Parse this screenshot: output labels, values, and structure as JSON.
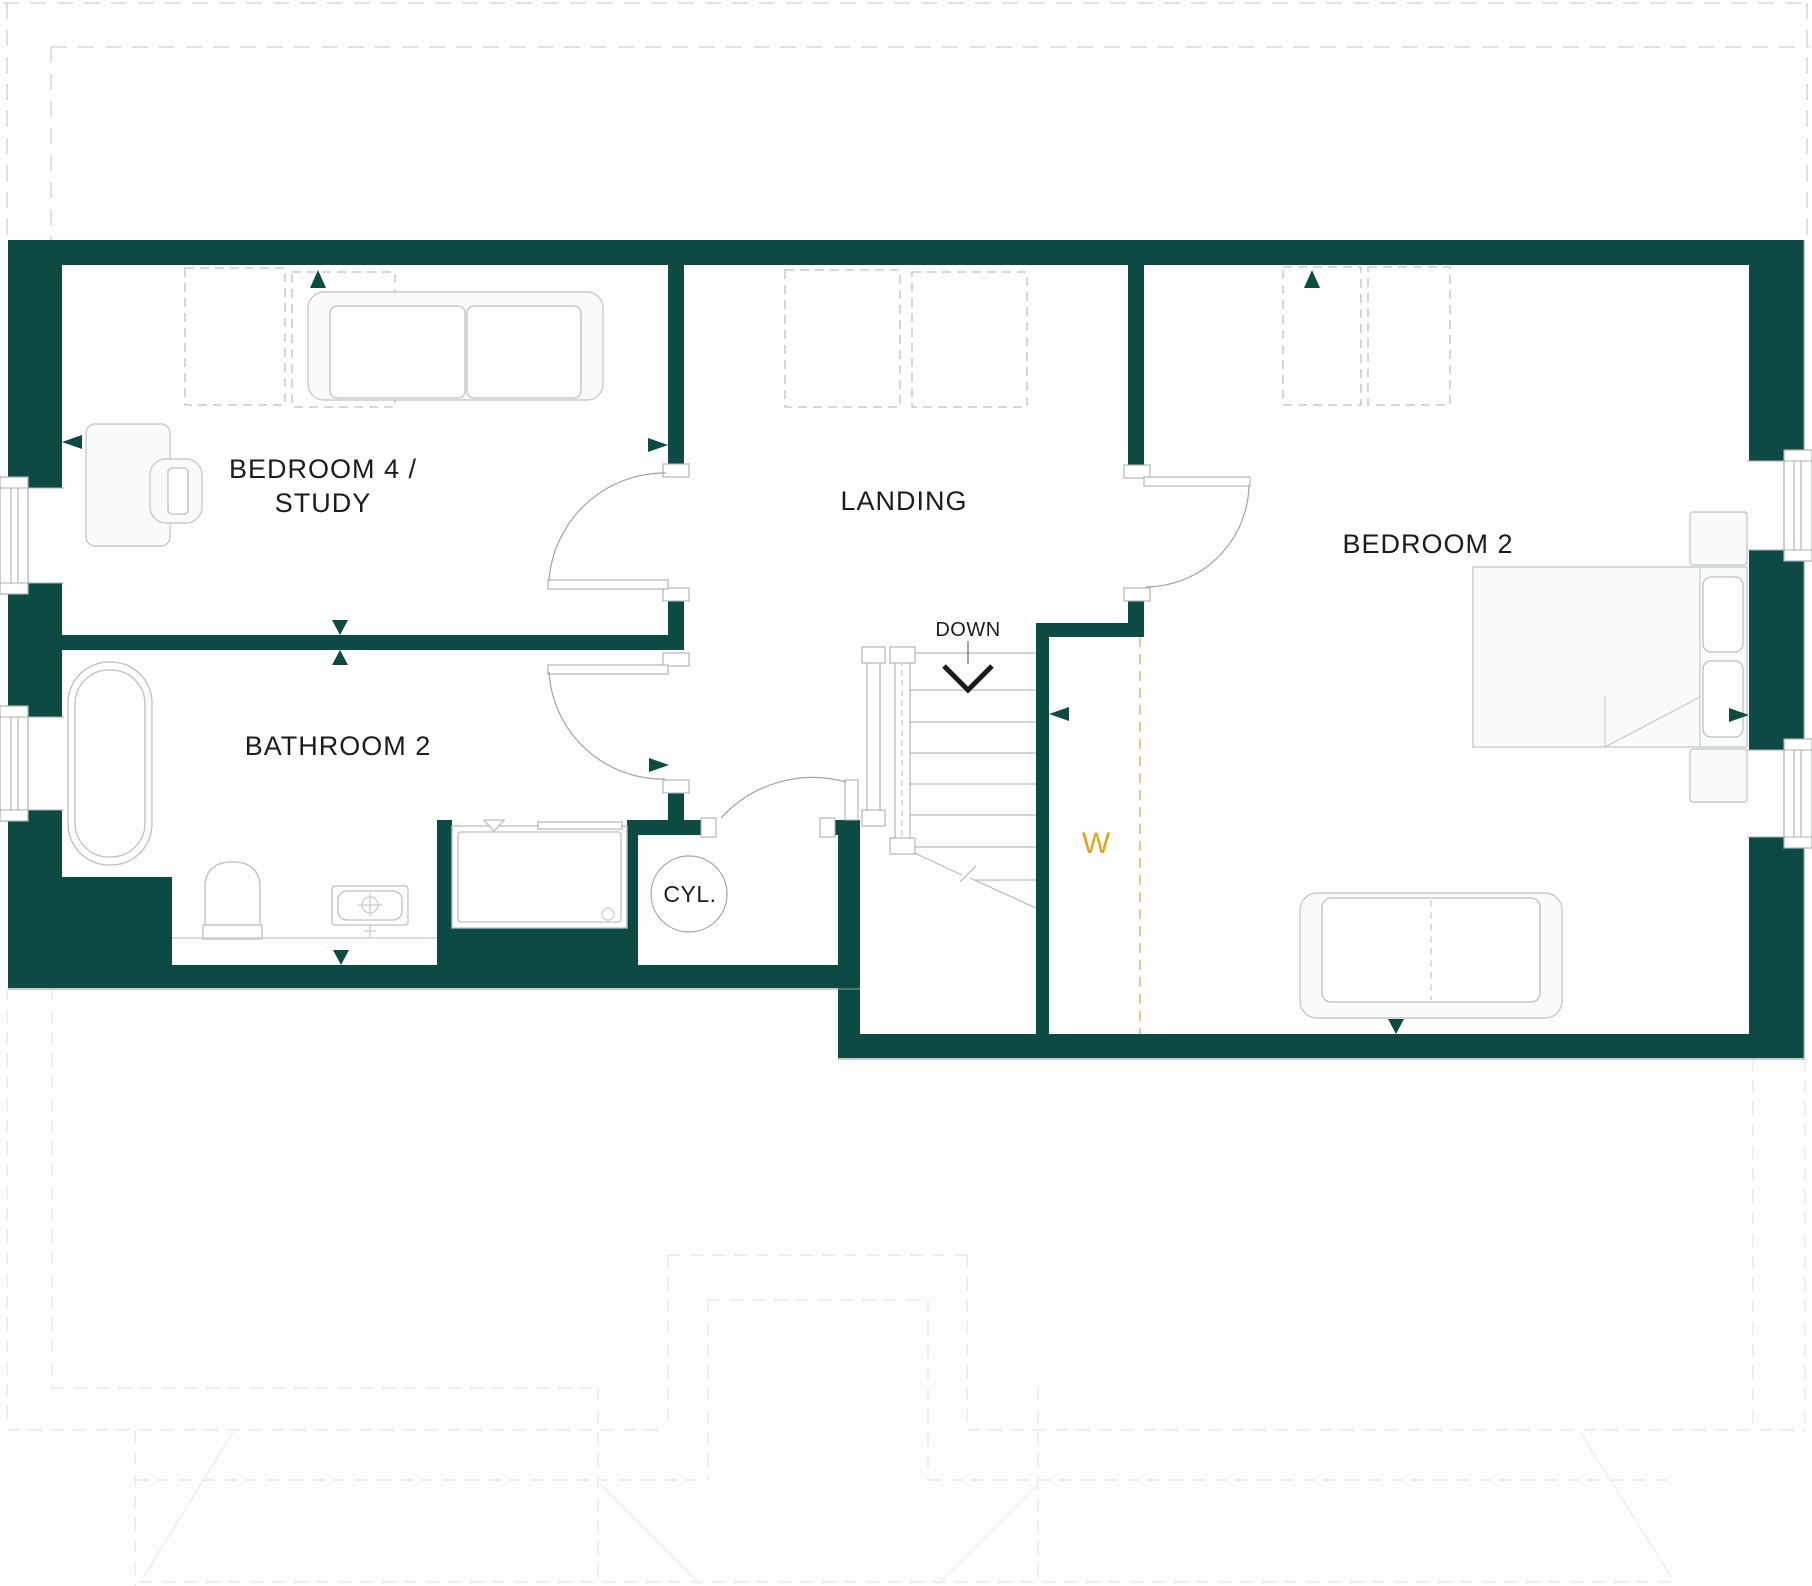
{
  "colors": {
    "wall": "#0d4a43",
    "ink": "#1c1c1c",
    "wardrobe": "#dfa51d",
    "wardrobe_dash": "#d8b45f",
    "furniture_stroke": "#c6cbca",
    "outline_dash": "#d6d9d9"
  },
  "labels": {
    "bedroom4_line1": "BEDROOM 4 /",
    "bedroom4_line2": "STUDY",
    "landing": "LANDING",
    "bedroom2": "BEDROOM 2",
    "bathroom2": "BATHROOM 2",
    "cylinder": "CYL.",
    "stairs_down": "DOWN",
    "wardrobe": "W"
  }
}
